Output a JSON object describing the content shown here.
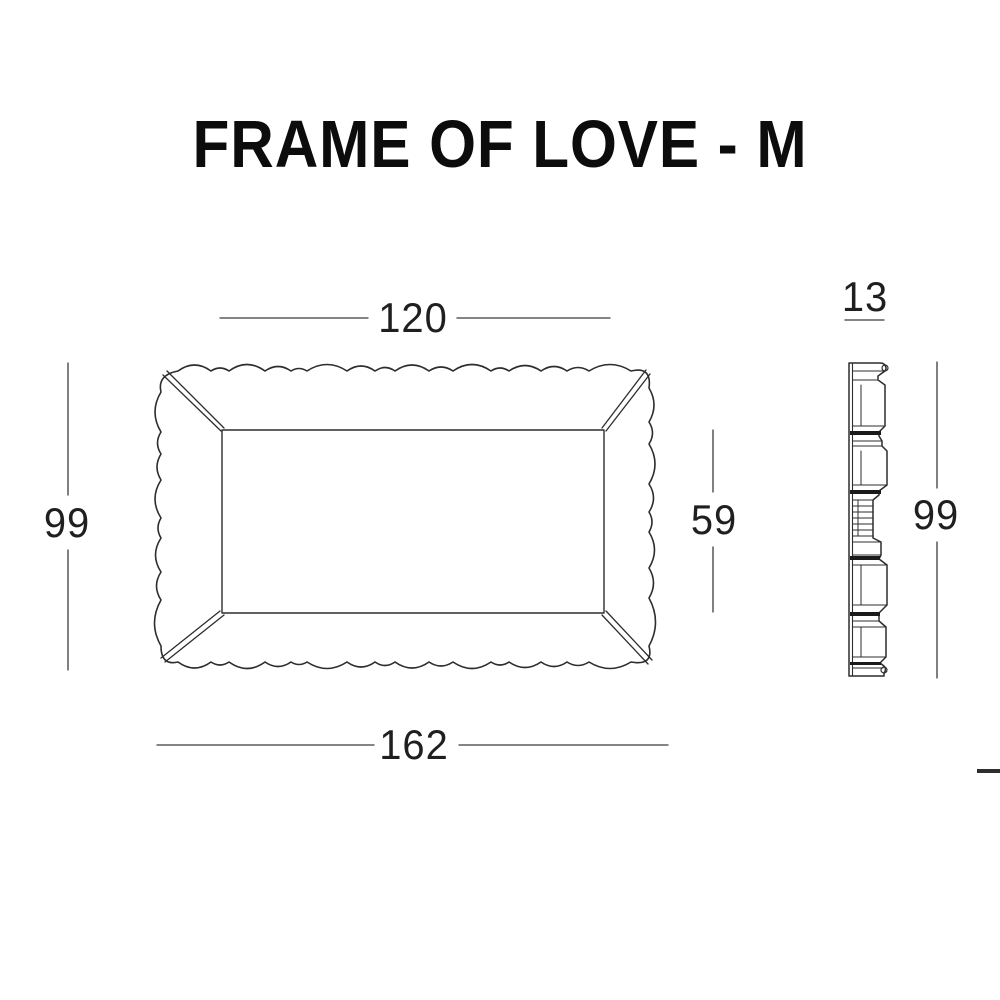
{
  "title": "FRAME OF LOVE - M",
  "views": {
    "front": {
      "inner_width_label": "120",
      "outer_width_label": "162",
      "outer_height_label": "99",
      "inner_height_label": "59"
    },
    "side": {
      "depth_label": "13",
      "height_label": "99"
    }
  },
  "colors": {
    "background": "#ffffff",
    "linework": "#2d2d2d",
    "dimension_line": "#3c3c3c",
    "text": "#1f1f1f",
    "title_text": "#0c0c0c"
  }
}
